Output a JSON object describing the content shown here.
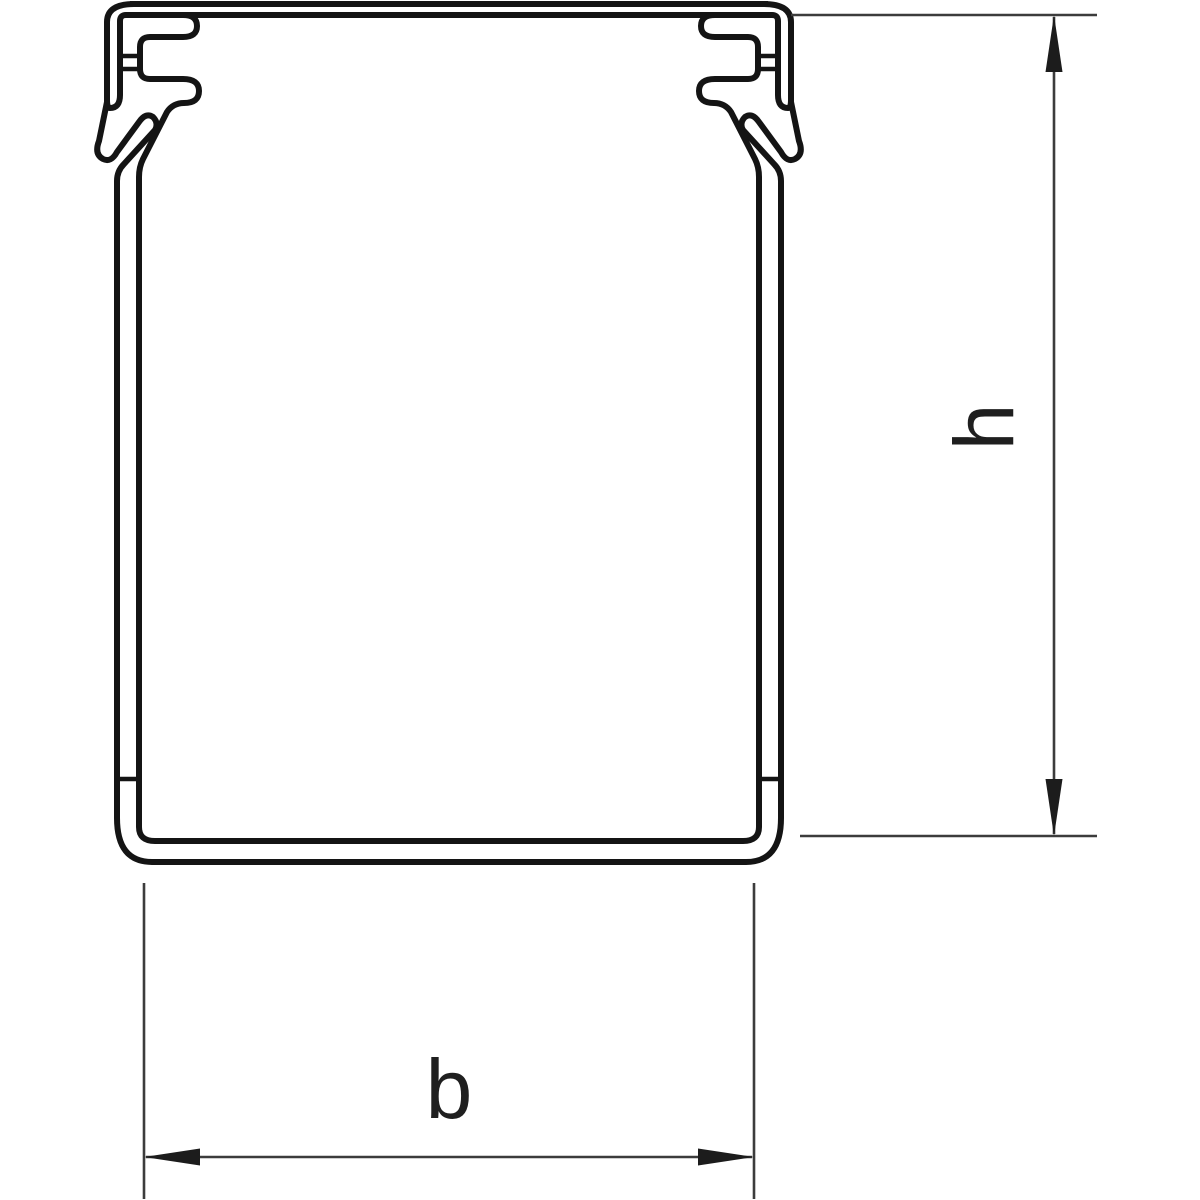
{
  "drawing": {
    "type": "technical-cross-section",
    "subject": "cable-trunking-profile",
    "labels": {
      "height": "h",
      "width": "b"
    },
    "colors": {
      "background": "#ffffff",
      "profile_stroke": "#141414",
      "dimension_stroke": "#3c3c3c",
      "arrow_fill": "#1c1c1c",
      "label_color": "#1f1f1f"
    }
  }
}
